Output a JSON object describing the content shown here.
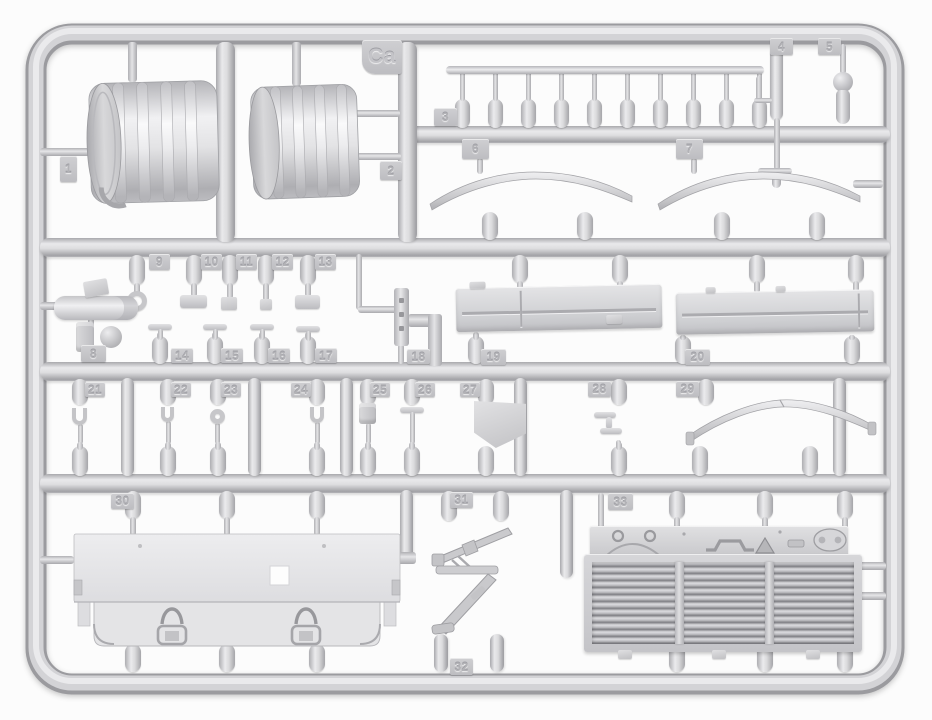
{
  "scene": {
    "subject": "Injection-molded light gray plastic model kit sprue (runner frame) with numbered parts",
    "sprue_frame_label": "Ca",
    "background_color": "#fcfcfc",
    "plastic_color": "#d5d5d8",
    "plastic_highlight": "#ebebed",
    "plastic_shadow": "#a2a2a6"
  },
  "part_tags": [
    {
      "label": "Ca",
      "x": 362,
      "y": 40,
      "w": 40,
      "h": 34
    },
    {
      "label": "1",
      "x": 60,
      "y": 156,
      "w": 17,
      "h": 26
    },
    {
      "label": "2",
      "x": 380,
      "y": 161,
      "w": 22,
      "h": 19
    },
    {
      "label": "3",
      "x": 434,
      "y": 108,
      "w": 23,
      "h": 18
    },
    {
      "label": "4",
      "x": 770,
      "y": 38,
      "w": 23,
      "h": 17
    },
    {
      "label": "5",
      "x": 818,
      "y": 38,
      "w": 23,
      "h": 17
    },
    {
      "label": "6",
      "x": 462,
      "y": 139,
      "w": 27,
      "h": 20
    },
    {
      "label": "7",
      "x": 676,
      "y": 139,
      "w": 27,
      "h": 20
    },
    {
      "label": "8",
      "x": 81,
      "y": 345,
      "w": 25,
      "h": 17
    },
    {
      "label": "9",
      "x": 149,
      "y": 254,
      "w": 21,
      "h": 16
    },
    {
      "label": "10",
      "x": 201,
      "y": 254,
      "w": 21,
      "h": 16
    },
    {
      "label": "11",
      "x": 236,
      "y": 254,
      "w": 21,
      "h": 16
    },
    {
      "label": "12",
      "x": 272,
      "y": 254,
      "w": 21,
      "h": 16
    },
    {
      "label": "13",
      "x": 315,
      "y": 254,
      "w": 21,
      "h": 16
    },
    {
      "label": "14",
      "x": 171,
      "y": 348,
      "w": 22,
      "h": 15
    },
    {
      "label": "15",
      "x": 221,
      "y": 348,
      "w": 22,
      "h": 15
    },
    {
      "label": "16",
      "x": 268,
      "y": 348,
      "w": 22,
      "h": 15
    },
    {
      "label": "17",
      "x": 315,
      "y": 348,
      "w": 22,
      "h": 15
    },
    {
      "label": "18",
      "x": 407,
      "y": 349,
      "w": 23,
      "h": 15
    },
    {
      "label": "19",
      "x": 481,
      "y": 349,
      "w": 25,
      "h": 16
    },
    {
      "label": "20",
      "x": 685,
      "y": 349,
      "w": 25,
      "h": 16
    },
    {
      "label": "21",
      "x": 85,
      "y": 382,
      "w": 20,
      "h": 15
    },
    {
      "label": "22",
      "x": 171,
      "y": 382,
      "w": 20,
      "h": 15
    },
    {
      "label": "23",
      "x": 221,
      "y": 382,
      "w": 20,
      "h": 15
    },
    {
      "label": "24",
      "x": 291,
      "y": 382,
      "w": 20,
      "h": 15
    },
    {
      "label": "25",
      "x": 370,
      "y": 382,
      "w": 20,
      "h": 15
    },
    {
      "label": "26",
      "x": 415,
      "y": 382,
      "w": 20,
      "h": 15
    },
    {
      "label": "27",
      "x": 460,
      "y": 382,
      "w": 20,
      "h": 15
    },
    {
      "label": "28",
      "x": 588,
      "y": 381,
      "w": 23,
      "h": 16
    },
    {
      "label": "29",
      "x": 676,
      "y": 381,
      "w": 23,
      "h": 16
    },
    {
      "label": "30",
      "x": 111,
      "y": 493,
      "w": 23,
      "h": 16
    },
    {
      "label": "31",
      "x": 450,
      "y": 492,
      "w": 23,
      "h": 16
    },
    {
      "label": "32",
      "x": 450,
      "y": 658,
      "w": 23,
      "h": 17
    },
    {
      "label": "33",
      "x": 608,
      "y": 493,
      "w": 25,
      "h": 17
    }
  ]
}
